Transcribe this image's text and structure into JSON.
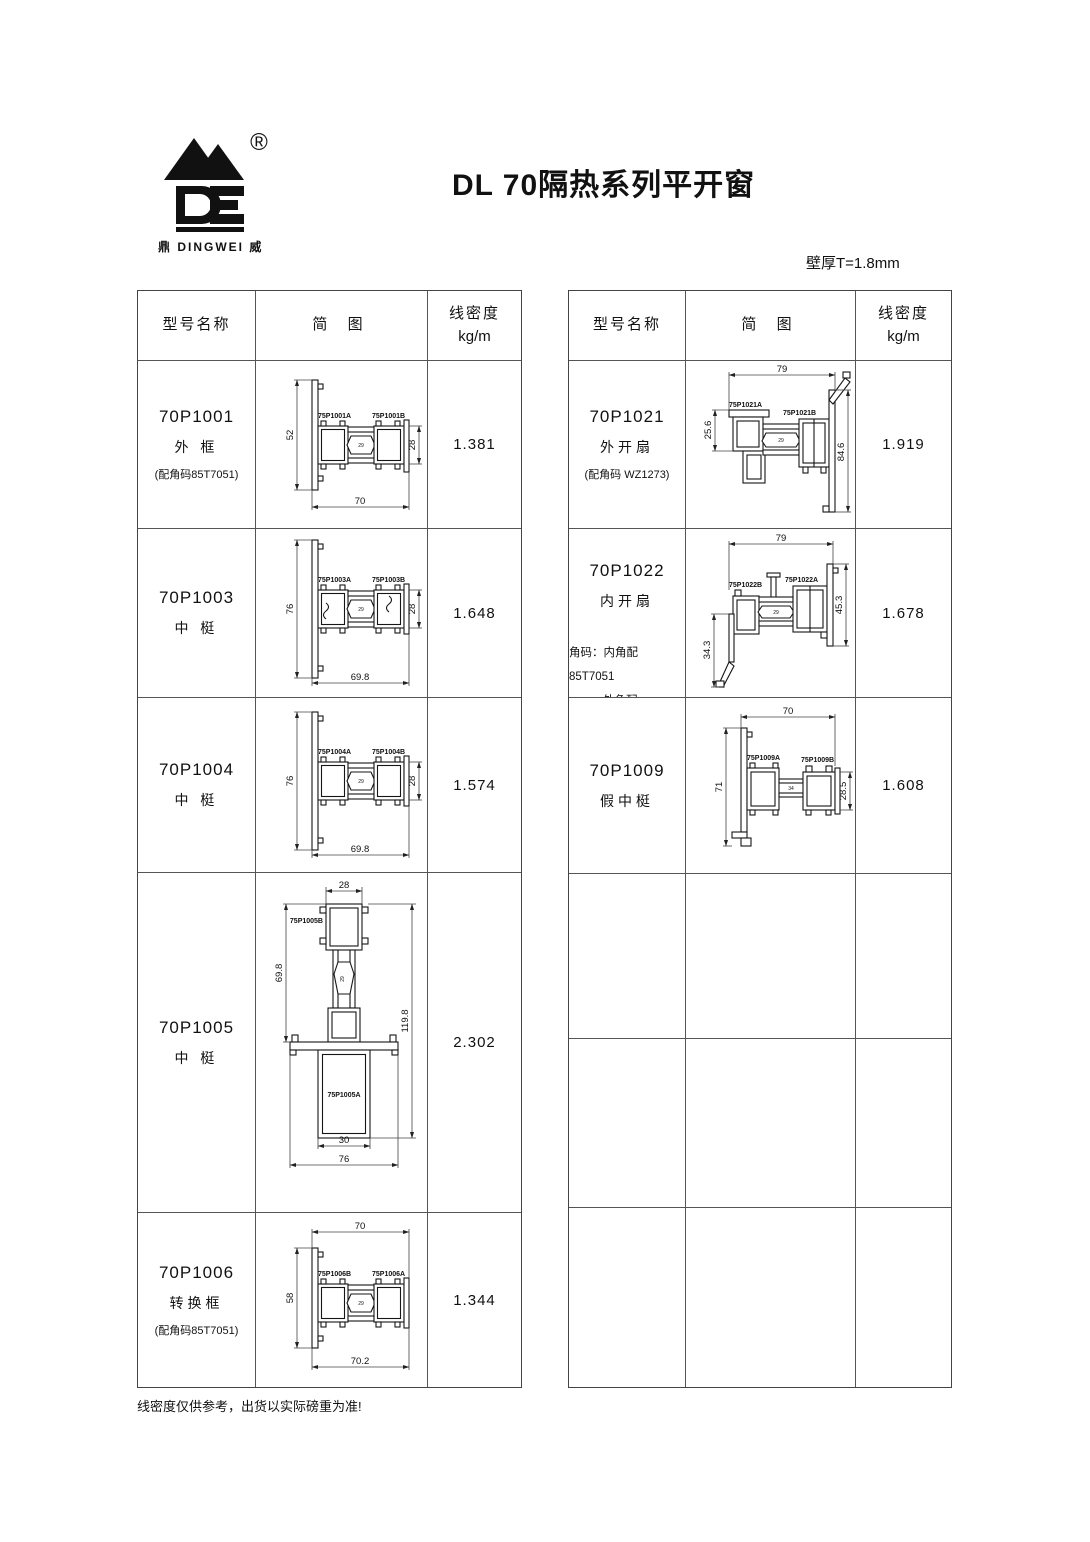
{
  "page": {
    "title": "DL 70隔热系列平开窗",
    "thickness_note": "壁厚T=1.8mm",
    "footer_note": "线密度仅供参考，出货以实际磅重为准!"
  },
  "logo": {
    "registered": "®",
    "caption": "鼎 DINGWEI 威"
  },
  "table_header": {
    "model": "型号名称",
    "diagram": "简 图",
    "density_line1": "线密度",
    "density_line2": "kg/m"
  },
  "left_rows": [
    {
      "model": "70P1001",
      "name": "外 框",
      "note": "(配角码85T7051)",
      "density": "1.381",
      "diagram": {
        "label_left": "75P1001A",
        "label_right": "75P1001B",
        "dim_left": "52",
        "dim_right": "28",
        "dim_bottom": "70",
        "dim_core": "29"
      }
    },
    {
      "model": "70P1003",
      "name": "中 梃",
      "note": "",
      "density": "1.648",
      "diagram": {
        "label_left": "75P1003A",
        "label_right": "75P1003B",
        "dim_left": "76",
        "dim_right": "28",
        "dim_bottom": "69.8",
        "dim_core": "29"
      }
    },
    {
      "model": "70P1004",
      "name": "中 梃",
      "note": "",
      "density": "1.574",
      "diagram": {
        "label_left": "75P1004A",
        "label_right": "75P1004B",
        "dim_left": "76",
        "dim_right": "28",
        "dim_bottom": "69.8",
        "dim_core": "29"
      }
    },
    {
      "model": "70P1005",
      "name": "中 梃",
      "note": "",
      "density": "2.302",
      "diagram": {
        "label_top": "75P1005B",
        "label_bottom": "75P1005A",
        "dim_top": "28",
        "dim_left": "69.8",
        "dim_right": "119.8",
        "dim_bottom_inner": "30",
        "dim_bottom_outer": "76",
        "dim_core": "29"
      }
    },
    {
      "model": "70P1006",
      "name": "转换框",
      "note": "(配角码85T7051)",
      "density": "1.344",
      "diagram": {
        "label_left": "75P1006B",
        "label_right": "75P1006A",
        "dim_top": "70",
        "dim_left": "58",
        "dim_bottom": "70.2",
        "dim_core": "29"
      }
    }
  ],
  "right_rows": [
    {
      "model": "70P1021",
      "name": "外开扇",
      "note": "(配角码 WZ1273)",
      "density": "1.919",
      "diagram": {
        "label_left": "75P1021A",
        "label_right": "75P1021B",
        "dim_top": "79",
        "dim_left": "25.6",
        "dim_right": "84.6",
        "dim_core": "29"
      }
    },
    {
      "model": "70P1022",
      "name": "内开扇",
      "note_lines": [
        "角码：内角配 85T7051",
        "外角配 YS00120"
      ],
      "density": "1.678",
      "diagram": {
        "label_left": "75P1022B",
        "label_right": "75P1022A",
        "dim_top": "79",
        "dim_left": "34.3",
        "dim_right": "45.3",
        "dim_core": "29"
      }
    },
    {
      "model": "70P1009",
      "name": "假中梃",
      "note": "",
      "density": "1.608",
      "diagram": {
        "label_left": "75P1009A",
        "label_right": "75P1009B",
        "dim_top": "70",
        "dim_left": "71",
        "dim_right": "28.5",
        "dim_core": "34"
      }
    }
  ]
}
